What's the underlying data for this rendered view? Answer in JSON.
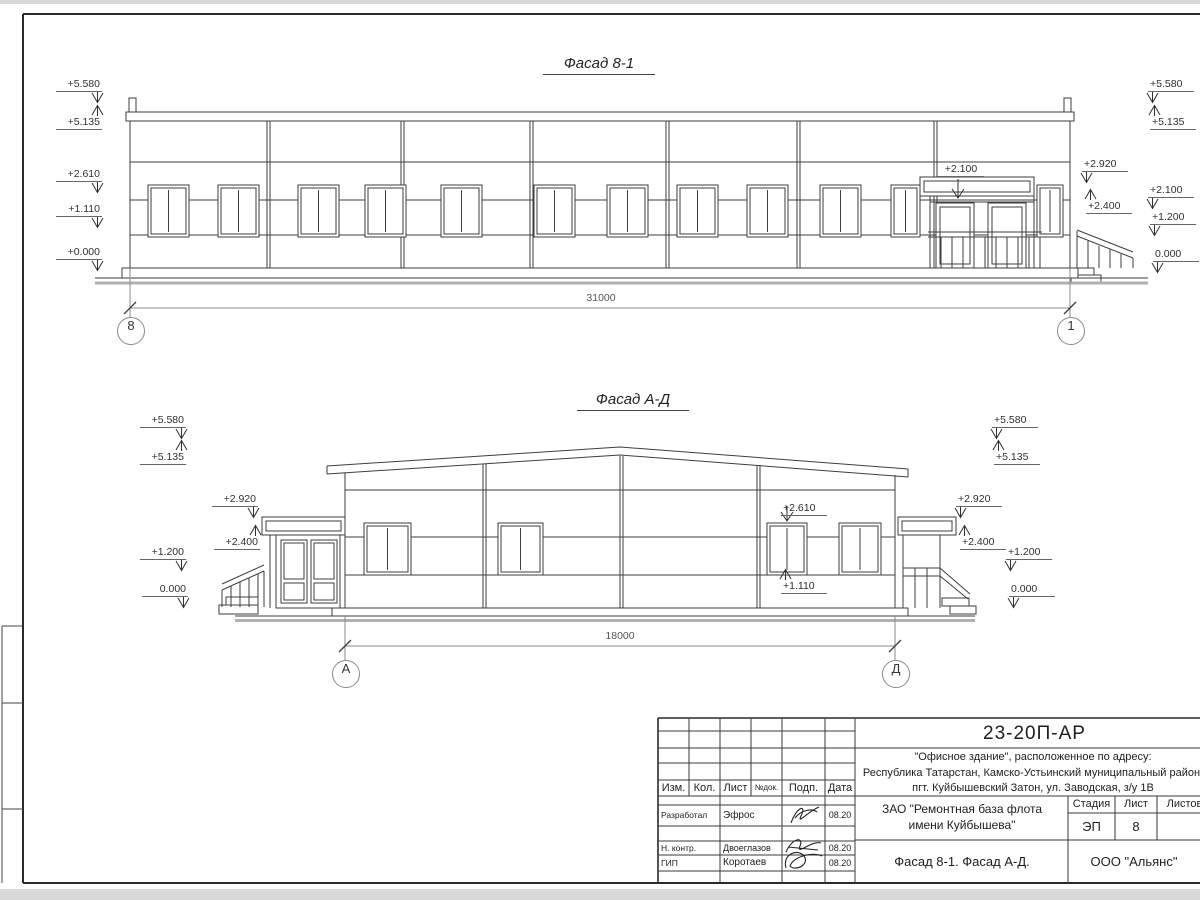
{
  "facade1": {
    "title": "Фасад 8-1",
    "dimension": "31000",
    "axis_left": "8",
    "axis_right": "1",
    "door_mark": "+2.100",
    "marks_left": [
      "+5.580",
      "+5.135",
      "+2.610",
      "+1.110",
      "+0.000"
    ],
    "marks_right": [
      "+5.580",
      "+5.135",
      "+2.920",
      "+2.400",
      "+2.100",
      "+1.200",
      "0.000"
    ]
  },
  "facade2": {
    "title": "Фасад А-Д",
    "dimension": "18000",
    "axis_left": "А",
    "axis_right": "Д",
    "window_marks": {
      "head": "+2.610",
      "sill": "+1.110"
    },
    "marks_left": [
      "+5.580",
      "+5.135",
      "+2.920",
      "+2.400",
      "+1.200",
      "0.000"
    ],
    "marks_right": [
      "+5.580",
      "+5.135",
      "+2.920",
      "+2.400",
      "+1.200",
      "0.000"
    ]
  },
  "title_block": {
    "doc_number": "23-20П-АР",
    "address_lines": [
      "\"Офисное здание\", расположенное по адресу:",
      "Республика Татарстан, Камско-Устьинский муниципальный район,",
      "пгт. Куйбышевский Затон, ул. Заводская, з/у 1В"
    ],
    "client_lines": [
      "ЗАО \"Ремонтная база флота",
      "имени Куйбышева\""
    ],
    "sheet_title": "Фасад 8-1. Фасад А-Д.",
    "company": "ООО \"Альянс\"",
    "stage_label": "Стадия",
    "sheet_label": "Лист",
    "sheets_label": "Листов",
    "stage_value": "ЭП",
    "sheet_value": "8",
    "columns": [
      "Изм.",
      "Кол.",
      "Лист",
      "№док.",
      "Подп.",
      "Дата"
    ],
    "rows": [
      {
        "role": "Разработал",
        "name": "Эфрос",
        "date": "08.20"
      },
      {
        "role": "Н. контр.",
        "name": "Двоеглазов",
        "date": "08.20"
      },
      {
        "role": "ГИП",
        "name": "Коротаев",
        "date": "08.20"
      }
    ]
  }
}
